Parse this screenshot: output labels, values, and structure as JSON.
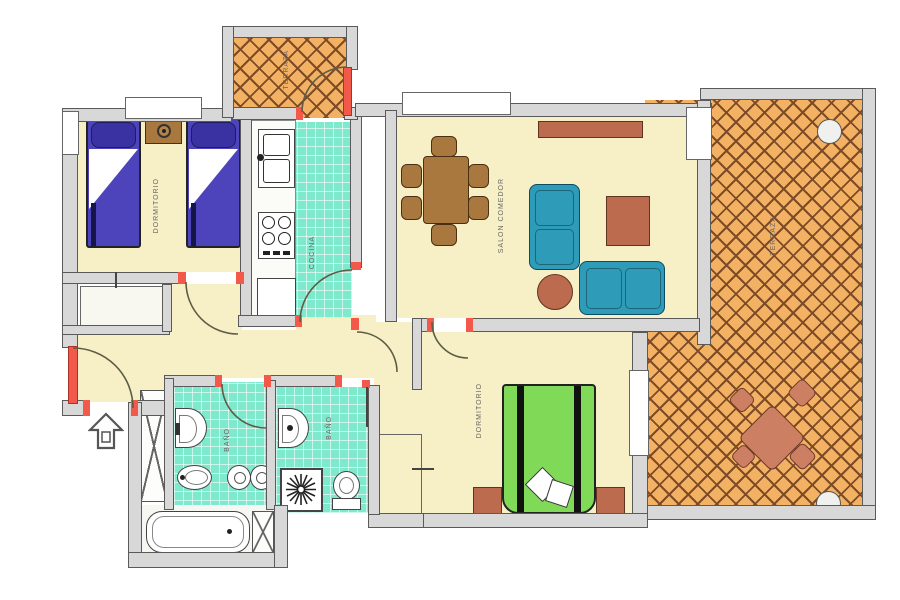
{
  "rooms": {
    "bedroom1": {
      "label": "DORMITORIO"
    },
    "bedroom2": {
      "label": "DORMITORIO"
    },
    "kitchen": {
      "label": "COCINA"
    },
    "living": {
      "label": "SALON COMEDOR"
    },
    "bath1": {
      "label": "BAÑO"
    },
    "bath2": {
      "label": "BAÑO"
    },
    "terrace": {
      "label": "TERRAZA"
    },
    "balcony": {
      "label": "TERRAZA"
    }
  },
  "colors": {
    "wall": "#d8d8d8",
    "wall_line": "#5a5a5a",
    "floor": "#f7efc6",
    "tile": "#7ee9cc",
    "terrace": "#f3b163",
    "lattice": "#7d4b26",
    "bed_blue": "#4d44bb",
    "bed_blue_dark": "#3a32a2",
    "bed_green": "#80da58",
    "sofa": "#2e9bb8",
    "wood": "#a8783f",
    "terracotta": "#bc6b4e",
    "terracotta_light": "#cd7f63",
    "door_red": "#f2594b",
    "label": "#666666"
  }
}
